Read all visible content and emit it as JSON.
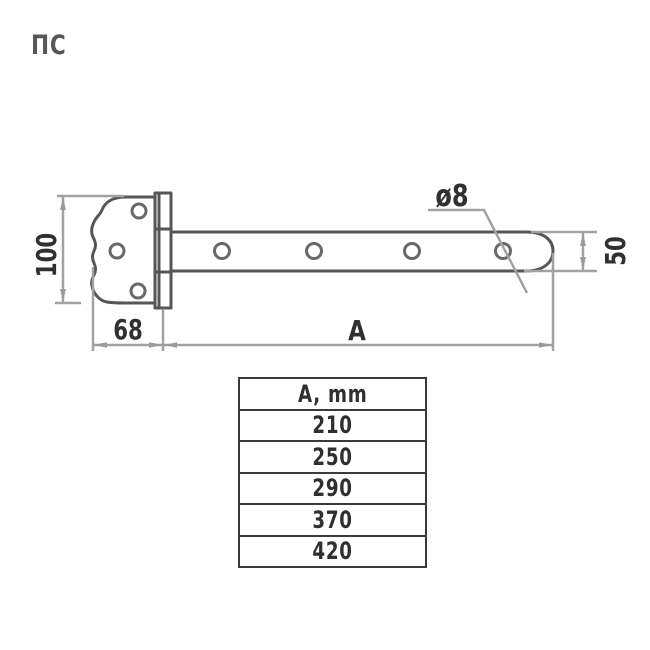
{
  "title": {
    "label": "ПС"
  },
  "drawing": {
    "type": "technical-drawing-strap-hinge",
    "dims": {
      "plate_height": "100",
      "plate_width": "68",
      "strap_length": "A",
      "strap_height": "50",
      "hole_diameter": "ø8"
    },
    "colors": {
      "part_outline": "#565656",
      "hole_outline": "#686868",
      "dimension_line": "#a2a2a2",
      "dimension_text": "#303030",
      "background": "#ffffff"
    }
  },
  "table": {
    "header": "A, mm",
    "rows": [
      "210",
      "250",
      "290",
      "370",
      "420"
    ]
  }
}
